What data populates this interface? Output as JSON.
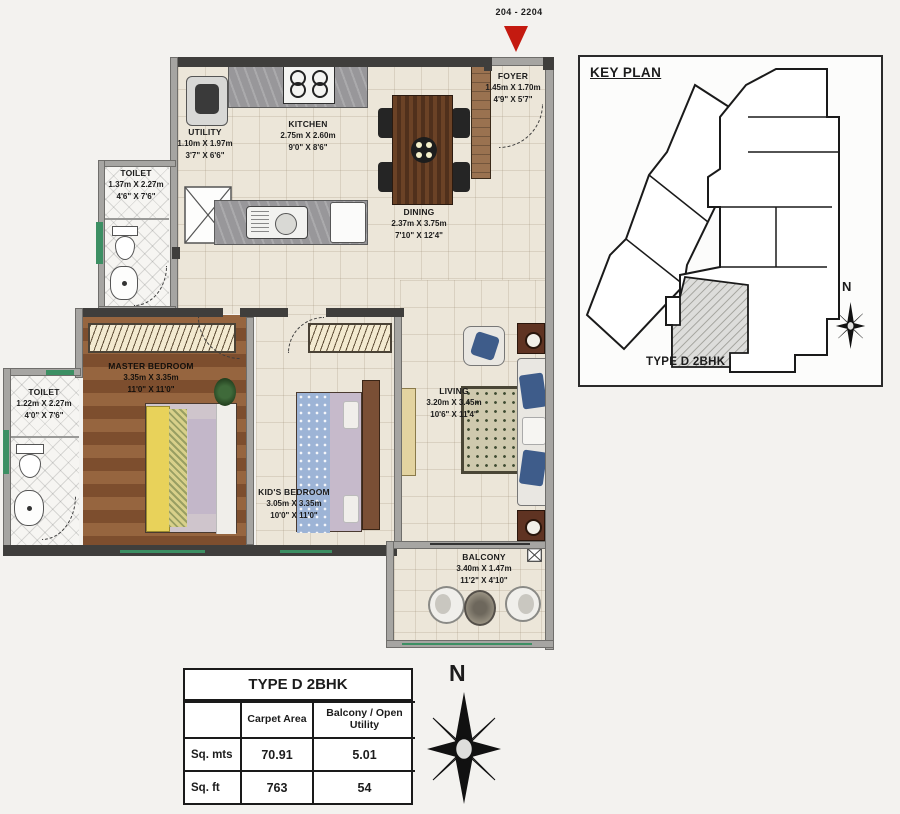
{
  "marker": {
    "unit_range": "204 - 2204"
  },
  "rooms": {
    "foyer": {
      "name": "FOYER",
      "m": "1.45m X 1.70m",
      "ft": "4'9\" X 5'7\""
    },
    "utility": {
      "name": "UTILITY",
      "m": "1.10m X 1.97m",
      "ft": "3'7\" X 6'6\""
    },
    "kitchen": {
      "name": "KITCHEN",
      "m": "2.75m X 2.60m",
      "ft": "9'0\" X 8'6\""
    },
    "dining": {
      "name": "DINING",
      "m": "2.37m X 3.75m",
      "ft": "7'10\" X 12'4\""
    },
    "toilet_top": {
      "name": "TOILET",
      "m": "1.37m X 2.27m",
      "ft": "4'6\" X 7'6\""
    },
    "toilet_left": {
      "name": "TOILET",
      "m": "1.22m X 2.27m",
      "ft": "4'0\" X 7'6\""
    },
    "master_bedroom": {
      "name": "MASTER BEDROOM",
      "m": "3.35m X 3.35m",
      "ft": "11'0\" X 11'0\""
    },
    "kids_bedroom": {
      "name": "KID'S BEDROOM",
      "m": "3.05m X 3.35m",
      "ft": "10'0\" X 11'0\""
    },
    "living": {
      "name": "LIVING",
      "m": "3.20m X 3.45m",
      "ft": "10'6\" X 11'4\""
    },
    "balcony": {
      "name": "BALCONY",
      "m": "3.40m X 1.47m",
      "ft": "11'2\" X 4'10\""
    }
  },
  "key_plan": {
    "title": "KEY PLAN",
    "unit_label": "TYPE D 2BHK",
    "north_label": "N"
  },
  "compass": {
    "north_label": "N"
  },
  "area_table": {
    "title": "TYPE D 2BHK",
    "columns": [
      "",
      "Carpet Area",
      "Balcony / Open Utility"
    ],
    "rows": [
      {
        "unit": "Sq. mts",
        "carpet": "70.91",
        "balcony": "5.01"
      },
      {
        "unit": "Sq. ft",
        "carpet": "763",
        "balcony": "54"
      }
    ]
  },
  "colors": {
    "marker_red": "#c41a10",
    "wall_dark": "#3f3e3c",
    "wall_light": "#a6a5a2",
    "window_green": "#3c8f63",
    "wood_floor": "#8a5a38"
  }
}
